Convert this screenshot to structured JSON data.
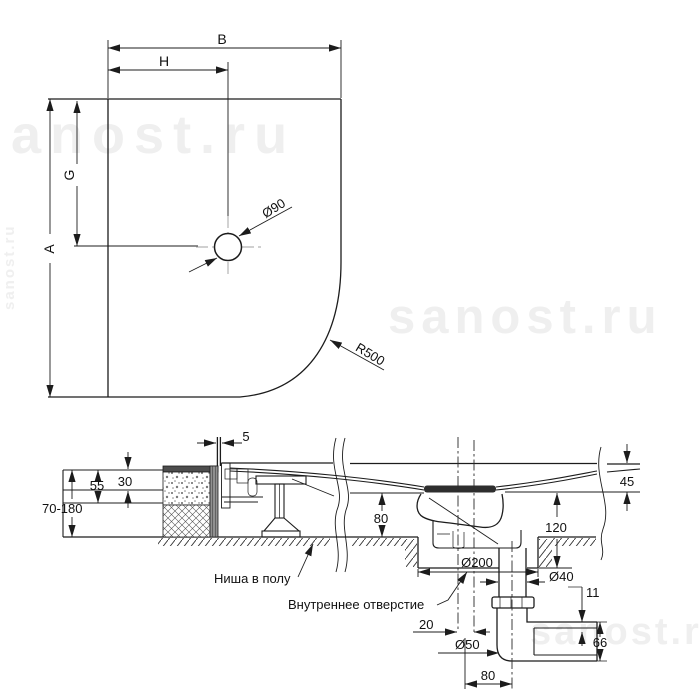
{
  "watermark": {
    "text": "sanost.ru"
  },
  "plan": {
    "dim_width": "B",
    "dim_drain_x": "H",
    "dim_drain_y": "G",
    "dim_depth": "A",
    "drain_diameter": "Ø90",
    "corner_radius": "R500"
  },
  "section": {
    "panel_thickness": "5",
    "tile_layer": "30",
    "screed_layer": "55",
    "floor_buildup_range": "70-180",
    "tray_edge_height": "45",
    "niche_height": "80",
    "niche_total_depth": "120",
    "niche_width": "Ø200",
    "pipe_diameter": "Ø40",
    "outlet_step": "11",
    "outlet_height": "66",
    "center_offset": "20",
    "outlet_diameter": "Ø50",
    "outlet_offset": "80",
    "label_floor_niche": "Ниша в полу",
    "label_inner_hole": "Внутреннее отверстие"
  }
}
